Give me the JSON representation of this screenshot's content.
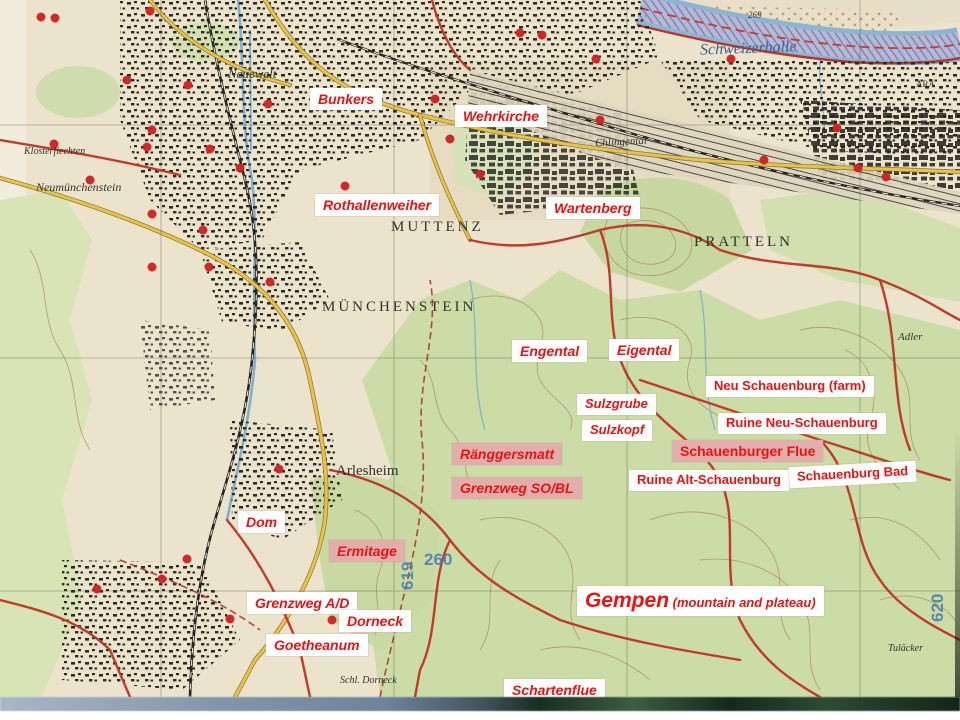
{
  "colors": {
    "label_text_red": "#ec1212",
    "label_bg_white": "#ffffff",
    "label_bg_pink": "#e2aeac",
    "map_paper": "#ece3cd",
    "map_forest_green": "#ccdca6",
    "map_road_red": "#bf3b2a",
    "map_road_yellow": "#e9c24a",
    "map_river_blue": "#8fb4d2",
    "map_grid_number_blue": "#4a80b0",
    "bunker_dot_red": "#cf2020"
  },
  "annotations": [
    {
      "id": "label-bunkers",
      "label": "Bunkers",
      "x": 310,
      "y": 88,
      "bg": "white",
      "italic": true,
      "size": 14
    },
    {
      "id": "label-wehrkirche",
      "label": "Wehrkirche",
      "x": 455,
      "y": 105,
      "bg": "white",
      "italic": true,
      "size": 14
    },
    {
      "id": "label-rothallenweiher",
      "label": "Rothallenweiher",
      "x": 315,
      "y": 194,
      "bg": "white",
      "italic": true,
      "size": 14
    },
    {
      "id": "label-wartenberg",
      "label": "Wartenberg",
      "x": 546,
      "y": 197,
      "bg": "white",
      "italic": true,
      "size": 14
    },
    {
      "id": "label-engental",
      "label": "Engental",
      "x": 512,
      "y": 340,
      "bg": "white",
      "italic": true,
      "size": 14
    },
    {
      "id": "label-eigental",
      "label": "Eigental",
      "x": 609,
      "y": 339,
      "bg": "white",
      "italic": true,
      "size": 14
    },
    {
      "id": "label-neu-schauenburg-farm",
      "label": "Neu Schauenburg (farm)",
      "x": 706,
      "y": 376,
      "bg": "white",
      "italic": false,
      "size": 13
    },
    {
      "id": "label-sulzgrube",
      "label": "Sulzgrube",
      "x": 577,
      "y": 394,
      "bg": "white",
      "italic": true,
      "size": 13
    },
    {
      "id": "label-sulzkopf",
      "label": "Sulzkopf",
      "x": 582,
      "y": 420,
      "bg": "white",
      "italic": true,
      "size": 13
    },
    {
      "id": "label-ruine-neu-schauenburg",
      "label": "Ruine Neu-Schauenburg",
      "x": 718,
      "y": 413,
      "bg": "white",
      "italic": false,
      "size": 13
    },
    {
      "id": "label-ranggersmatt",
      "label": "Ränggersmatt",
      "x": 452,
      "y": 443,
      "bg": "pink",
      "italic": true,
      "size": 14
    },
    {
      "id": "label-schauenburger-flue",
      "label": "Schauenburger Flue",
      "x": 672,
      "y": 440,
      "bg": "pink",
      "italic": false,
      "size": 14
    },
    {
      "id": "label-grenzweg-sobl",
      "label": "Grenzweg SO/BL",
      "x": 452,
      "y": 477,
      "bg": "pink",
      "italic": true,
      "size": 14
    },
    {
      "id": "label-ruine-alt-schauenburg",
      "label": "Ruine Alt-Schauenburg",
      "x": 629,
      "y": 470,
      "bg": "white",
      "italic": false,
      "size": 13
    },
    {
      "id": "label-schauenburg-bad",
      "label": "Schauenburg Bad",
      "x": 789,
      "y": 464,
      "bg": "white",
      "italic": false,
      "size": 13,
      "rotate": -3
    },
    {
      "id": "label-dom",
      "label": "Dom",
      "x": 238,
      "y": 511,
      "bg": "white",
      "italic": true,
      "size": 14
    },
    {
      "id": "label-ermitage",
      "label": "Ermitage",
      "x": 329,
      "y": 540,
      "bg": "pink",
      "italic": true,
      "size": 14
    },
    {
      "id": "label-grenzweg-ad",
      "label": "Grenzweg A/D",
      "x": 247,
      "y": 592,
      "bg": "white",
      "italic": true,
      "size": 14
    },
    {
      "id": "label-dorneck",
      "label": "Dorneck",
      "x": 339,
      "y": 610,
      "bg": "white",
      "italic": true,
      "size": 14
    },
    {
      "id": "label-goetheanum",
      "label": "Goetheanum",
      "x": 266,
      "y": 634,
      "bg": "white",
      "italic": true,
      "size": 14
    },
    {
      "id": "label-gempen",
      "label": "Gempen",
      "sub": " (mountain and plateau)",
      "x": 577,
      "y": 586,
      "bg": "white",
      "italic": true,
      "size": 21
    },
    {
      "id": "label-schartenflue",
      "label": "Schartenflue",
      "x": 504,
      "y": 679,
      "bg": "white",
      "italic": true,
      "size": 14
    }
  ],
  "map_names": [
    {
      "id": "map-name-neuewelt",
      "label": "Neuewelt",
      "x": 228,
      "y": 66,
      "size": 13,
      "style": "it"
    },
    {
      "id": "map-name-klosterfiechten",
      "label": "Klosterfiechten",
      "x": 24,
      "y": 146,
      "size": 10,
      "style": "it"
    },
    {
      "id": "map-name-neumunchenstein",
      "label": "Neumünchenstein",
      "x": 36,
      "y": 180,
      "size": 12,
      "style": "it"
    },
    {
      "id": "map-name-chlingental",
      "label": "Chlingental",
      "x": 595,
      "y": 136,
      "size": 11,
      "style": "it",
      "rotate": -3
    },
    {
      "id": "map-name-muttenz",
      "label": "MUTTENZ",
      "x": 391,
      "y": 219,
      "size": 15,
      "style": "caps"
    },
    {
      "id": "map-name-pratteln",
      "label": "PRATTELN",
      "x": 694,
      "y": 234,
      "size": 15,
      "style": "caps"
    },
    {
      "id": "map-name-munchenstein",
      "label": "MÜNCHENSTEIN",
      "x": 322,
      "y": 299,
      "size": 15,
      "style": "caps"
    },
    {
      "id": "map-name-arlesheim",
      "label": "Arlesheim",
      "x": 336,
      "y": 463,
      "size": 15,
      "style": "plain"
    },
    {
      "id": "map-name-schweizerhalle",
      "label": "Schweizerhalle",
      "x": 700,
      "y": 40,
      "size": 16,
      "style": "it blue",
      "rotate": -2
    },
    {
      "id": "map-name-ara",
      "label": "ARA",
      "x": 916,
      "y": 79,
      "size": 9,
      "style": "plain"
    },
    {
      "id": "map-name-adler",
      "label": "Adler",
      "x": 898,
      "y": 331,
      "size": 11,
      "style": "it"
    },
    {
      "id": "map-name-tulacker",
      "label": "Tuläcker",
      "x": 888,
      "y": 643,
      "size": 10,
      "style": "it"
    },
    {
      "id": "map-name-schl-dorneck",
      "label": "Schl. Dorneck",
      "x": 340,
      "y": 675,
      "size": 10,
      "style": "it"
    },
    {
      "id": "map-name-269",
      "label": "269",
      "x": 748,
      "y": 10,
      "size": 9,
      "style": "it"
    }
  ],
  "grid_numbers": [
    {
      "id": "grid-number-260",
      "label": "260",
      "x": 424,
      "y": 550,
      "vertical": false
    },
    {
      "id": "grid-number-619",
      "label": "619",
      "x": 398,
      "y": 590,
      "vertical": true
    },
    {
      "id": "grid-number-620",
      "label": "620",
      "x": 928,
      "y": 622,
      "vertical": true
    }
  ]
}
